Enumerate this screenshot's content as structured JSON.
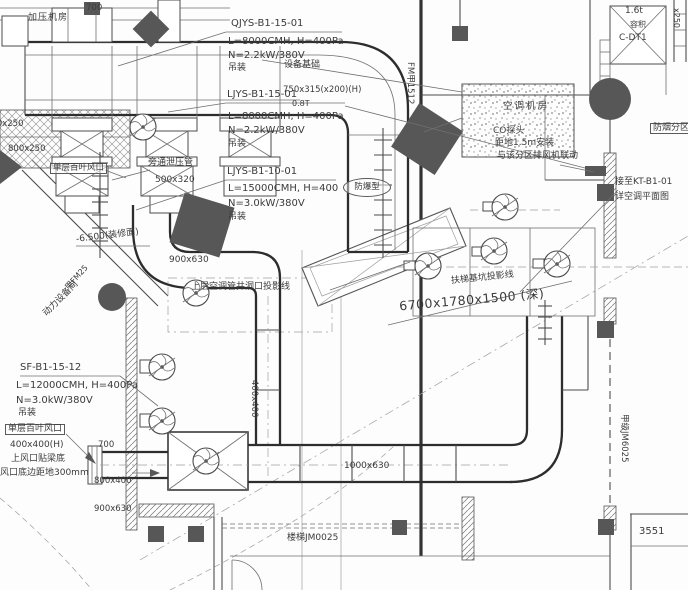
{
  "ink": "#3b3b3b",
  "specs": [
    {
      "tag": "QJYS-B1-15-01",
      "l": "L=8000CMH, H=400Pa",
      "n": "N=2.2kW/380V",
      "mount": "吊装",
      "note": "设备基础"
    },
    {
      "tag": "LJYS-B1-15-01",
      "overlay": "750x315(x200)(H)",
      "overlay2": "0.8T",
      "l": "L=8000CMH, H=400Pa",
      "n": "N=2.2kW/380V",
      "mount": "吊装"
    },
    {
      "tag": "LJYS-B1-10-01",
      "l": "L=15000CMH, H=400",
      "note": "防爆型",
      "n": "N=3.0kW/380V",
      "mount": "吊装"
    },
    {
      "tag": "SF-B1-15-12",
      "l": "L=12000CMH, H=400Pa",
      "n": "N=3.0kW/380V",
      "mount": "吊装"
    }
  ],
  "labels": {
    "dim_700_top": "700",
    "room_top_left": "加压机房",
    "bypass": "旁通泄压管",
    "bypass_size": "500x320",
    "louver_upper": "单层百叶风口",
    "power_room": "动力设备间",
    "door_tag": "甲FM25",
    "elevation": "-6.500(装修面)",
    "size_900x630": "900x630",
    "shaft_projection": "上层空调管井洞口投影线",
    "escalator": "扶梯基坑投影线",
    "pit_size": "6700x1780x1500 (深)",
    "ac_room": "空调机房",
    "co_probe": "CO探头",
    "co_note1": "距地1.5m安装",
    "co_note2": "与该分区排风机联动",
    "kt_line1": "接至KT-B1-01",
    "kt_line2": "详空调平面图",
    "smoke_zone": "防烟分区",
    "lift_cap": "1.6t",
    "lift_vol": "容积",
    "lift_tag": "C-DT1",
    "duct_x250": "x250",
    "duct_800x250": "800x250",
    "duct_0x250": "800x250",
    "louver_low": "单层百叶风口",
    "louver_low_size": "400x400(H)",
    "louver_note1": "上风口贴梁底",
    "louver_note2": "风口底边距地300mm",
    "dim_700_b": "700",
    "duct_800x400": "800x400",
    "duct_900x630_b": "900x630",
    "duct_400x400": "400x400",
    "duct_1000x630": "1000x630",
    "stair": "楼梯JM0025",
    "dim_3551": "3551",
    "wall_tag": "甲级JM6025",
    "fm_tag": "FM甲1512"
  }
}
